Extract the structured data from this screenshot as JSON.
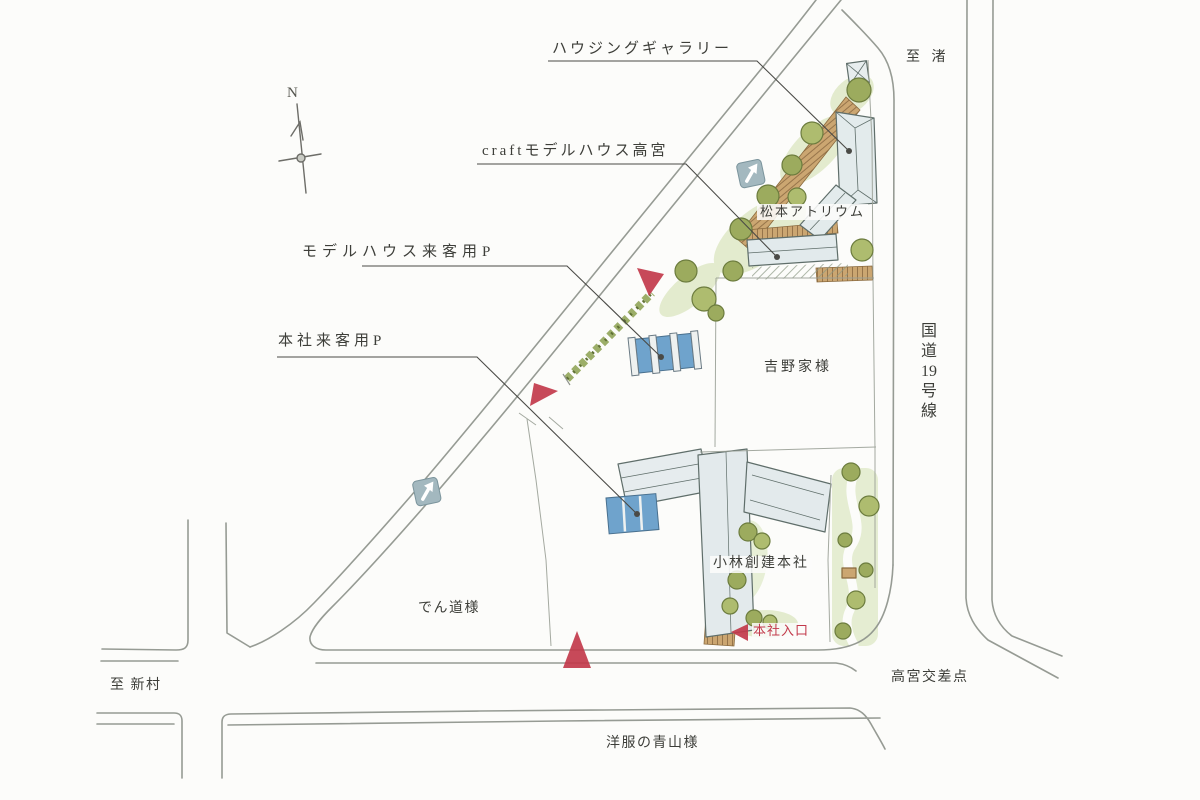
{
  "page": {
    "background_color": "#fcfcfa"
  },
  "compass": {
    "label": "N"
  },
  "road_signs": {
    "route_19_vertical": {
      "chars": [
        "国",
        "道",
        "19",
        "号",
        "線"
      ]
    },
    "one_way_arrow_count": 2
  },
  "callouts": {
    "housing_gallery": "ハウジングギャラリー",
    "craft_model_house_takamiya": "craftモデルハウス高宮",
    "model_house_visitor_parking": "モデルハウス来客用P",
    "head_office_visitor_parking": "本社来客用P"
  },
  "places": {
    "matsumoto_atrium": "松本アトリウム",
    "yoshinoya": "吉野家様",
    "kobayashi_soken_head_office": "小林創建本社",
    "head_office_entrance": "本社入口",
    "dendo": "でん道様",
    "takamiya_intersection": "高宮交差点",
    "yofuku_no_aoyama": "洋服の青山様"
  },
  "directions": {
    "to_nagisa": "至 渚",
    "to_niimura": "至 新村"
  },
  "colors": {
    "road_line": "#8e938b",
    "building_fill": "#e2eaec",
    "deck_wood": "#cba671",
    "tree_green": "#9cab5e",
    "under_green": "#dde7c4",
    "parking_blue": "#6fa3cc",
    "one_way_sign": "#a3b8bf",
    "entrance_marker_red": "#c2394b",
    "label_text": "#3d3e39"
  }
}
